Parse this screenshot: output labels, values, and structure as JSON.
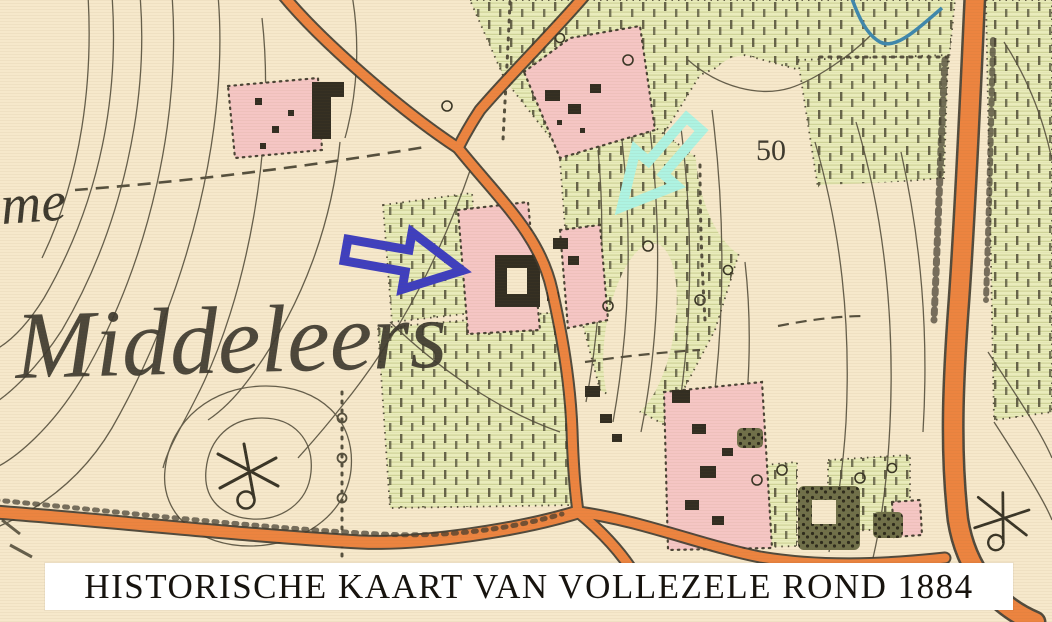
{
  "window": {
    "type": "historical-map-screenshot"
  },
  "map": {
    "labels": {
      "toponym_partial": "me",
      "toponym_main": "Middeleers",
      "elevation_mark": "50"
    },
    "palette": {
      "paper": "#f6e8cb",
      "road_orange": "#ec8440",
      "vegetation_green": "#e9edbb",
      "settlement_pink": "#f5c6c4",
      "ink": "#56503e",
      "water_blue": "#3f88ad",
      "annotation_arrow_blue": "#3f3fbe",
      "annotation_arrow_mint": "#aef3e2",
      "caption_background": "#ffffff",
      "caption_text_color": "#17130e"
    },
    "symbols": {
      "windmill_symbol_count": 2
    },
    "annotations": {
      "arrow_right": "blue outlined block arrow pointing right",
      "arrow_down_left": "mint outlined block arrow pointing down-left"
    }
  },
  "caption": {
    "text": "HISTORISCHE KAART VAN VOLLEZELE ROND 1884"
  }
}
